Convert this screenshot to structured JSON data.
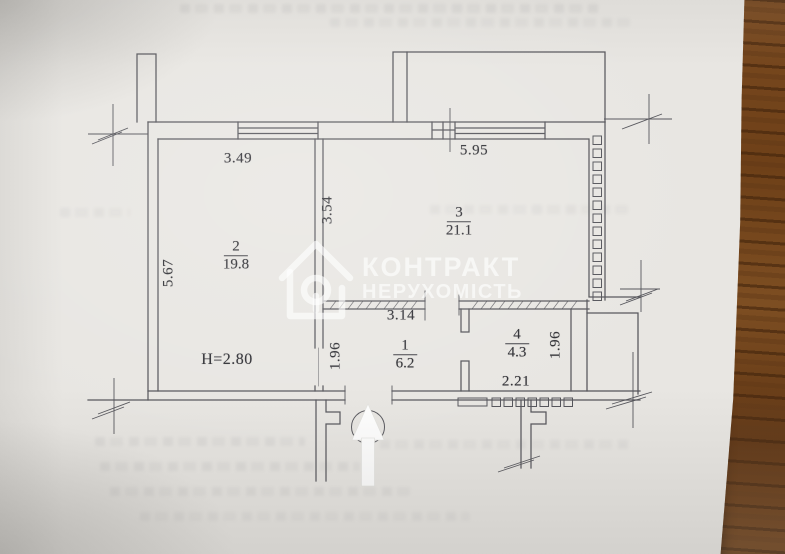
{
  "document": {
    "type_note": "scanned apartment floor plan photographed on wooden table",
    "watermark": {
      "line1": "КОНТРАКТ",
      "line2": "НЕРУХОМІСТЬ",
      "icon": "house-outline-icon",
      "color": "#ffffff"
    },
    "entrance_icon": "up-arrow-icon"
  },
  "plan": {
    "rooms": [
      {
        "number": "1",
        "area": "6.2"
      },
      {
        "number": "2",
        "area": "19.8"
      },
      {
        "number": "3",
        "area": "21.1"
      },
      {
        "number": "4",
        "area": "4.3"
      }
    ],
    "dimensions": {
      "room2_width": "3.49",
      "room3_width": "5.95",
      "room2_depth": "5.67",
      "partition_2_3": "3.54",
      "hall_width": "3.14",
      "hall_depth": "1.96",
      "room4_width": "2.21",
      "room4_depth": "1.96",
      "ceiling_height": "H=2.80"
    }
  },
  "colors": {
    "paper": "#e8e6e2",
    "ink_line": "#54545a",
    "label_text": "#2e2e33",
    "wood": "#6e4018",
    "watermark": "#ffffff"
  }
}
